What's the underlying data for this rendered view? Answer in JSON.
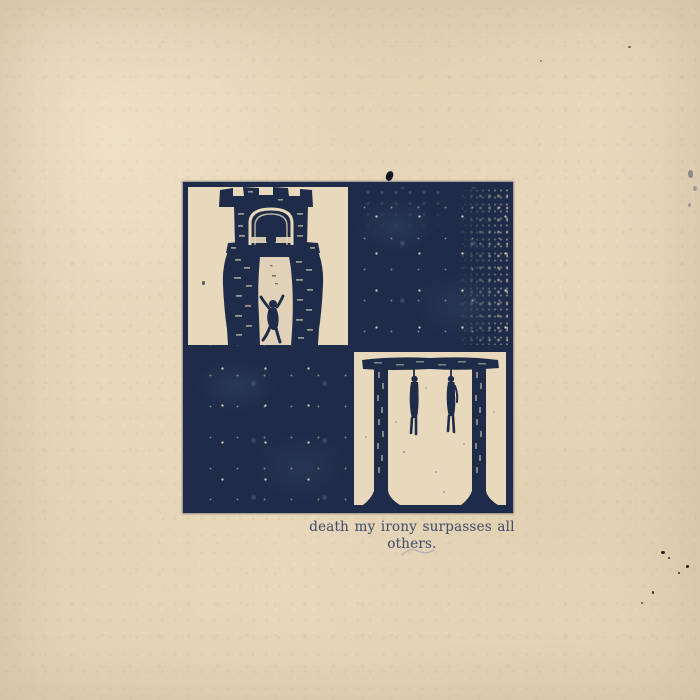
{
  "page": {
    "kind": "album-cover-artwork",
    "description": "aged beige paper with centered two-by-two woodcut print and caption"
  },
  "caption": {
    "text": "death my irony surpasses all others."
  },
  "artwork": {
    "grid": "2x2",
    "panels": [
      {
        "position": "top-left",
        "content": "tower-with-climbing-figure",
        "background": "cream"
      },
      {
        "position": "top-right",
        "content": "solid-ink-block",
        "background": "navy"
      },
      {
        "position": "bottom-left",
        "content": "solid-ink-block",
        "background": "navy"
      },
      {
        "position": "bottom-right",
        "content": "gallows-with-two-hanged-figures",
        "background": "cream"
      }
    ]
  },
  "colors": {
    "paper": "#e8d7bb",
    "ink_navy": "#1e2c49",
    "cream_panel": "#e9d9bc",
    "caption_ink": "#2e3f5f"
  }
}
